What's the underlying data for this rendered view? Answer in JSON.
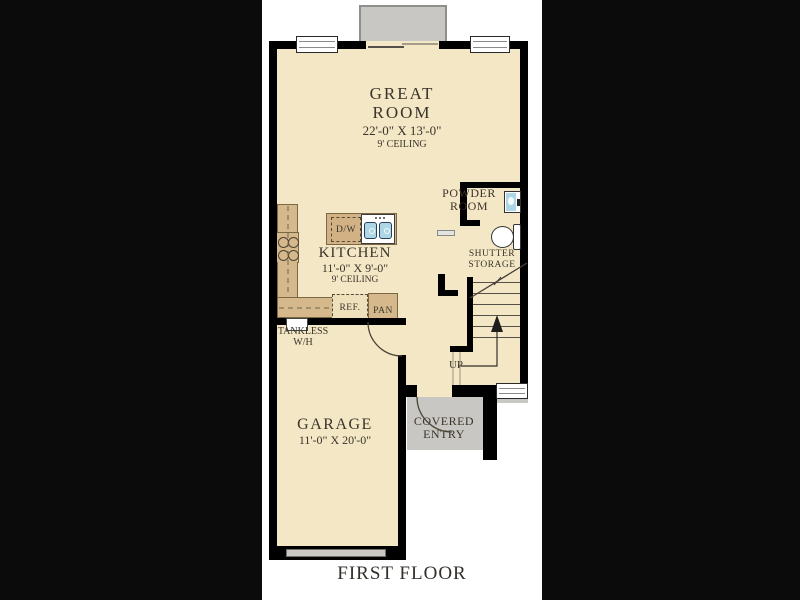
{
  "title": "FIRST FLOOR",
  "colors": {
    "background": "#0b0b0b",
    "paper": "#ffffff",
    "floor": "#f4e7c6",
    "counter": "#d5b98c",
    "concrete": "#c8c7c3",
    "wall": "#000000",
    "text": "#3a342a",
    "sink_blue": "#aed7e6"
  },
  "rooms": {
    "great_room": {
      "line1": "GREAT",
      "line2": "ROOM",
      "dims": "22'-0\" X 13'-0\"",
      "ceiling": "9' CEILING"
    },
    "kitchen": {
      "name": "KITCHEN",
      "dims": "11'-0\" X 9'-0\"",
      "ceiling": "9' CEILING"
    },
    "garage": {
      "name": "GARAGE",
      "dims": "11'-0\" X 20'-0\""
    },
    "powder_room": {
      "line1": "POWDER",
      "line2": "ROOM"
    },
    "shutter_storage": {
      "line1": "SHUTTER",
      "line2": "STORAGE"
    },
    "covered_entry": {
      "line1": "COVERED",
      "line2": "ENTRY"
    }
  },
  "fixtures": {
    "dishwasher": "D/W",
    "refrigerator": "REF.",
    "pantry": "PAN",
    "tankless_line1": "TANKLESS",
    "tankless_line2": "W/H",
    "up": "UP"
  }
}
